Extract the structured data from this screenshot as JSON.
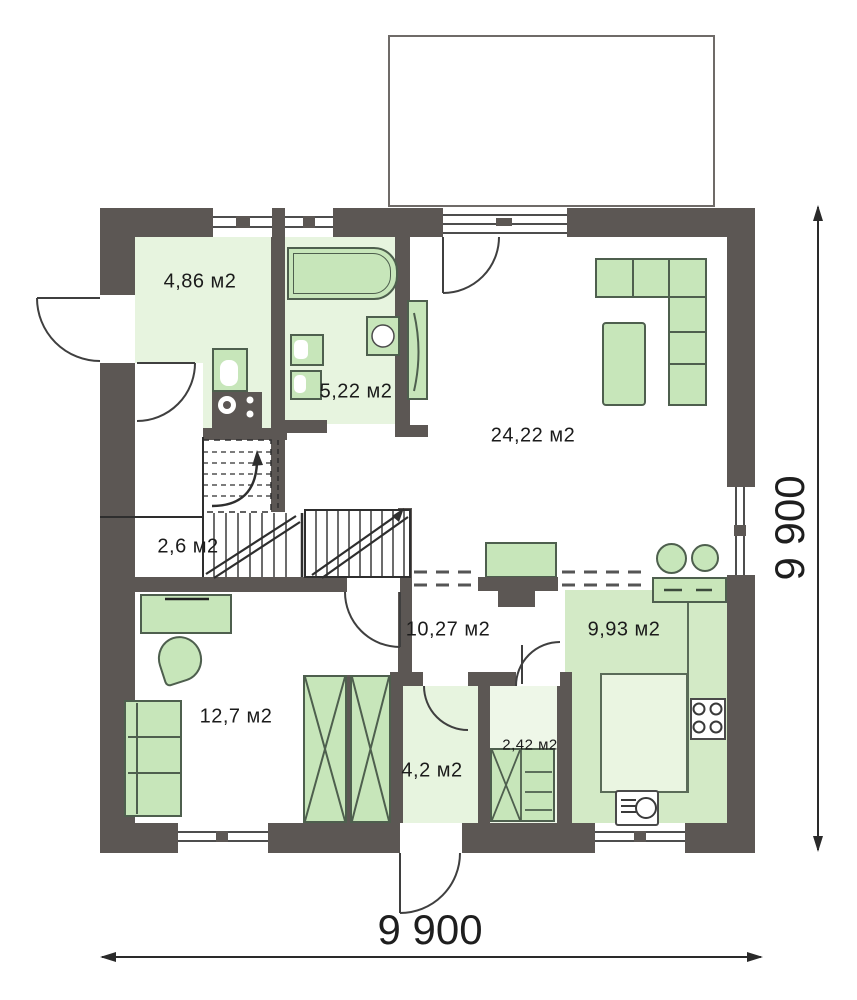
{
  "plan_title": "floor-plan",
  "rooms": {
    "tambour": {
      "area": "4,86 м2"
    },
    "bathroom": {
      "area": "5,22 м2"
    },
    "living": {
      "area": "24,22 м2"
    },
    "stair_hall": {
      "area": "2,6 м2"
    },
    "hall": {
      "area": "10,27 м2"
    },
    "kitchen": {
      "area": "9,93 м2"
    },
    "bedroom": {
      "area": "12,7 м2"
    },
    "entry": {
      "area": "4,2 м2"
    },
    "closet": {
      "area": "2,42 м2"
    }
  },
  "dimensions": {
    "width": "9 900",
    "height": "9 900"
  },
  "colors": {
    "wall": "#5c5754",
    "furniture": "#c7e6ba",
    "furniture_outline": "#4e5f4e",
    "floor_green": "#e7f4df",
    "kitchen_floor": "#d3eac6"
  }
}
